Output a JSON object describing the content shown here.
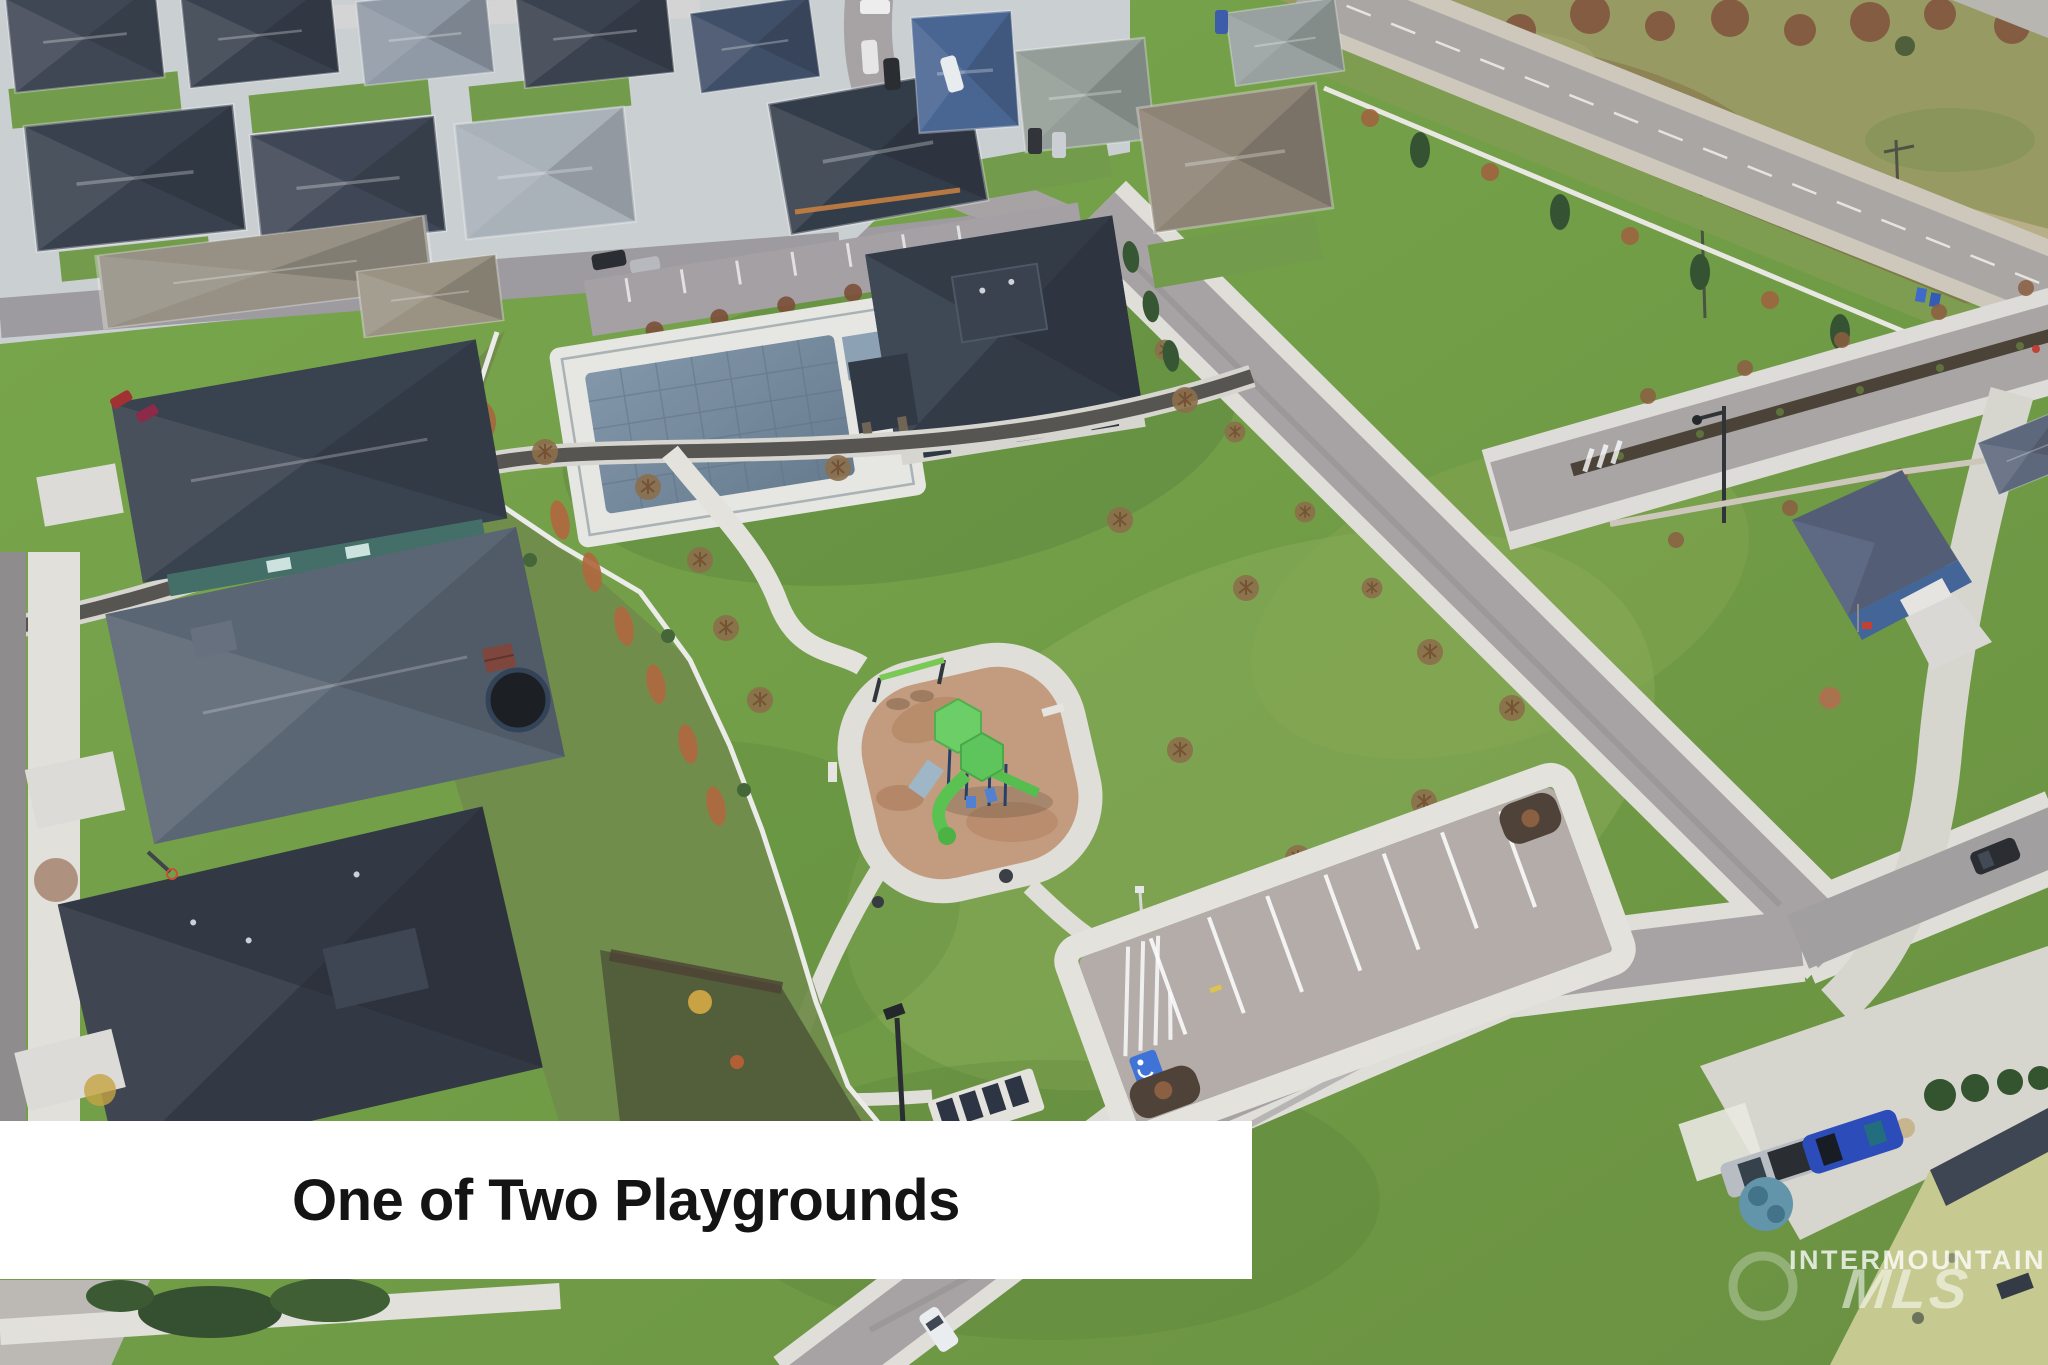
{
  "photo": {
    "type": "aerial-drone-photo",
    "subject": "neighborhood park with playground, walking paths, clubhouse pool, parking lot and surrounding homes",
    "caption_banner": {
      "text": "One of Two Playgrounds",
      "bg": "#ffffff",
      "fg": "#141414"
    },
    "watermark": {
      "line1": "INTERMOUNTAIN",
      "line2": "MLS",
      "color": "#ffffff"
    },
    "palette": {
      "park_grass": "#71a13f",
      "lawn_dark": "#4f7c33",
      "lawn_light": "#9dba5f",
      "field_olive": "#97985e",
      "road_asphalt": "#a7a2a3",
      "concrete": "#dedcd6",
      "sidewalk": "#e4e2dc",
      "roof_dark": "#2d3440",
      "roof_gray": "#57616f",
      "playground_mulch": "#c59a7c",
      "play_green": "#68cf60",
      "pool_cover": "#7a8fa5",
      "fence_white": "#efeeea",
      "bare_tree": "#a05c36",
      "evergreen": "#2f4d2a",
      "handicap_blue": "#3a6fd8",
      "banner_bg": "#ffffff",
      "banner_fg": "#141414"
    }
  }
}
